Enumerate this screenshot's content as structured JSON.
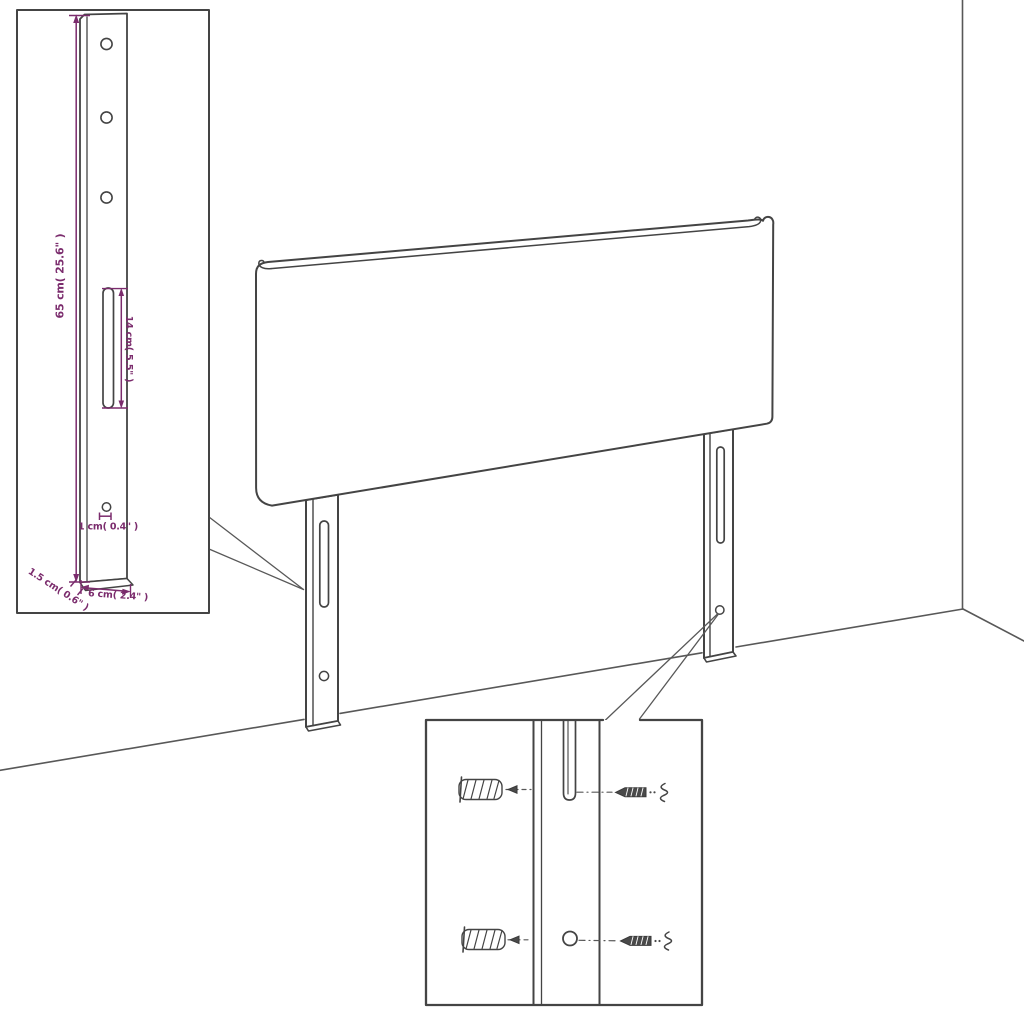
{
  "colors": {
    "line": "#444444",
    "room_line": "#585858",
    "accent": "#7b2c6d",
    "background": "#ffffff"
  },
  "detail_view": {
    "labels": {
      "height": "65 cm( 25.6\" )",
      "slot": "14 cm( 5.5\" )",
      "hole": "1 cm( 0.4\" )",
      "thickness": "1.5 cm( 0.6\" )",
      "width": "6 cm( 2.4\" )"
    }
  },
  "icons": {
    "left_inset": "leg-dimension-detail",
    "bottom_inset": "wall-mounting-detail",
    "wall_plug": "wall-plug-anchor-icon",
    "screw": "wood-screw-icon"
  }
}
